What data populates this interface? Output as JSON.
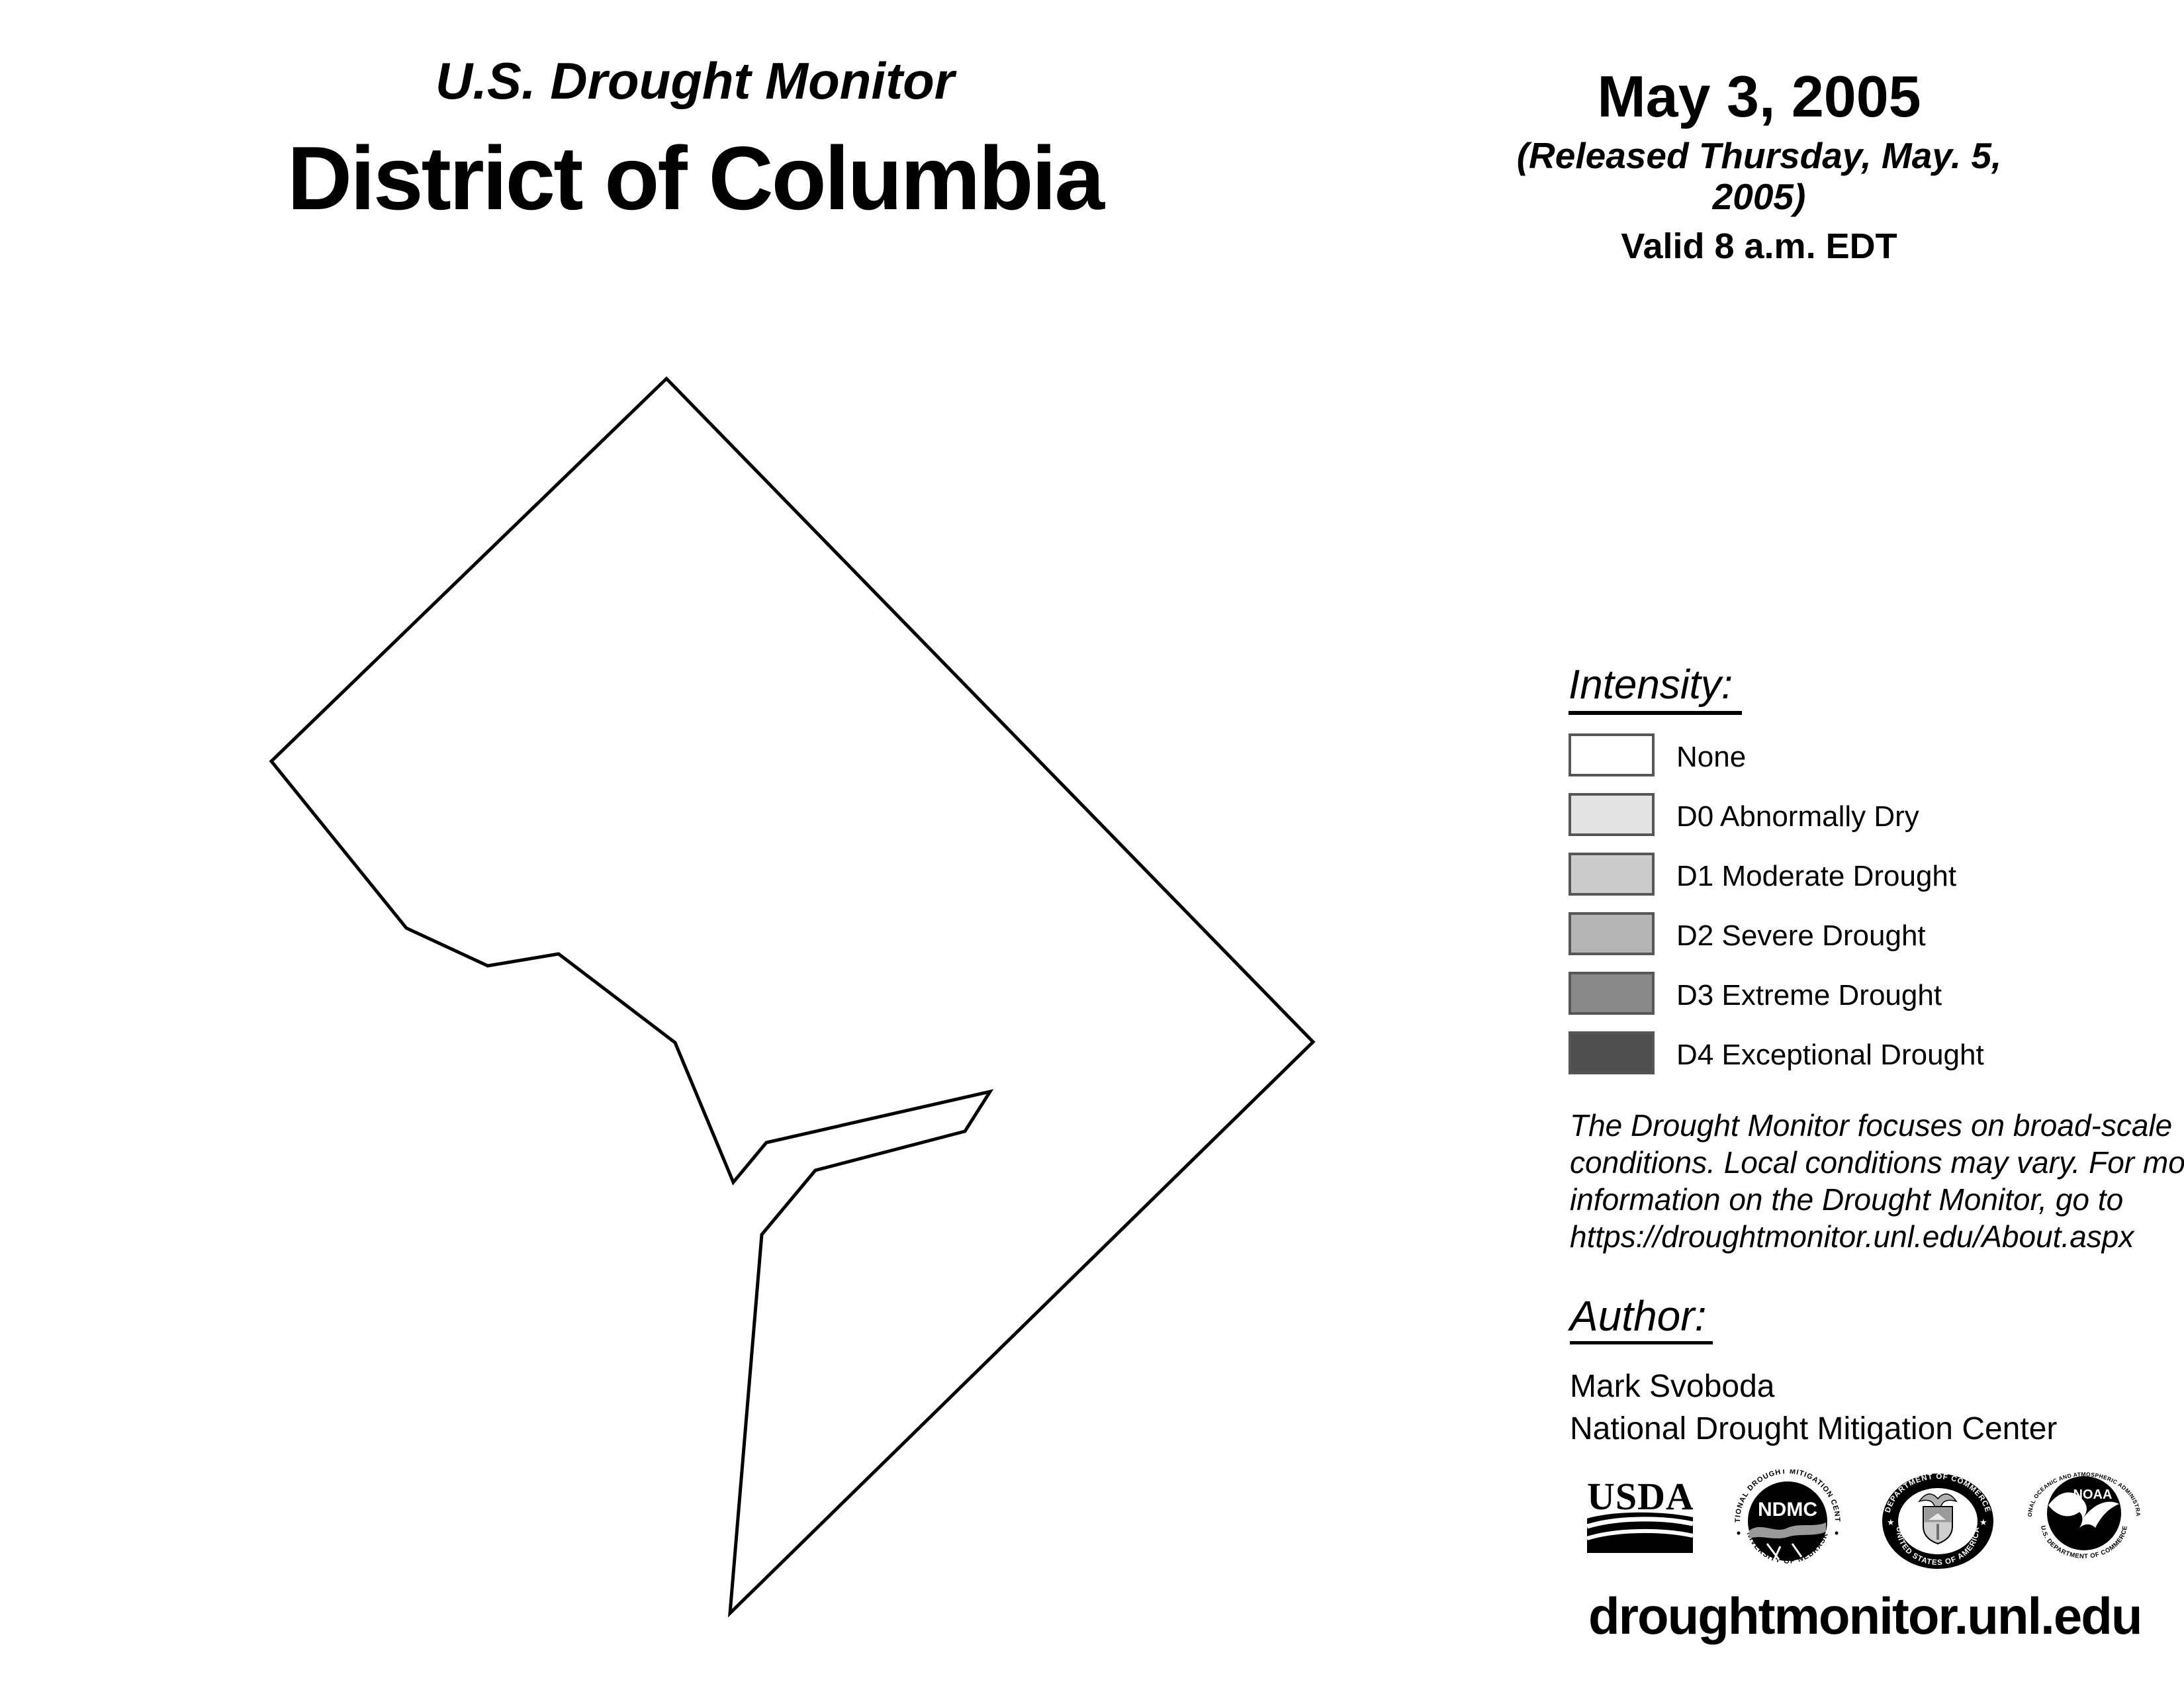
{
  "header": {
    "kicker": "U.S. Drought Monitor",
    "region_title": "District of Columbia",
    "date": "May 3, 2005",
    "released": "(Released Thursday, May. 5, 2005)",
    "valid": "Valid 8 a.m. EDT"
  },
  "legend": {
    "heading": "Intensity:",
    "swatch_border_color": "#565656",
    "items": [
      {
        "label": "None",
        "color": "#ffffff"
      },
      {
        "label": "D0 Abnormally Dry",
        "color": "#e3e3e3"
      },
      {
        "label": "D1 Moderate Drought",
        "color": "#cbcbcb"
      },
      {
        "label": "D2 Severe Drought",
        "color": "#b4b4b4"
      },
      {
        "label": "D3 Extreme Drought",
        "color": "#8a8a8a"
      },
      {
        "label": "D4 Exceptional Drought",
        "color": "#4f4f4f"
      }
    ]
  },
  "disclaimer_lines": [
    "The Drought Monitor focuses on broad-scale",
    "conditions. Local conditions may vary. For more",
    "information on the Drought Monitor, go to",
    "https://droughtmonitor.unl.edu/About.aspx"
  ],
  "author": {
    "heading": "Author:",
    "name": "Mark Svoboda",
    "organization": "National Drought Mitigation Center"
  },
  "footer": {
    "url": "droughtmonitor.unl.edu"
  },
  "logos": {
    "usda": {
      "wordmark": "USDA"
    },
    "ndmc": {
      "ring_top": "NATIONAL DROUGHT MITIGATION CENTER",
      "ring_bottom": "UNIVERSITY OF NEBRASKA",
      "monogram": "NDMC"
    },
    "commerce": {
      "ring_top": "DEPARTMENT OF COMMERCE",
      "ring_bottom": "UNITED STATES OF AMERICA"
    },
    "noaa": {
      "ring_top": "NATIONAL OCEANIC AND ATMOSPHERIC ADMINISTRATION",
      "ring_bottom": "U.S. DEPARTMENT OF COMMERCE",
      "monogram": "NOAA"
    }
  },
  "map": {
    "region": "District of Columbia",
    "fill": "#ffffff",
    "outline_color": "#000000",
    "outline_points": "1007,572 1984,1574 1103,2437 1151,1865 1232,1768 1458,1709 1496,1649 1158,1726 1108,1786 1020,1575 844,1441 737,1459 614,1402 410,1150"
  }
}
